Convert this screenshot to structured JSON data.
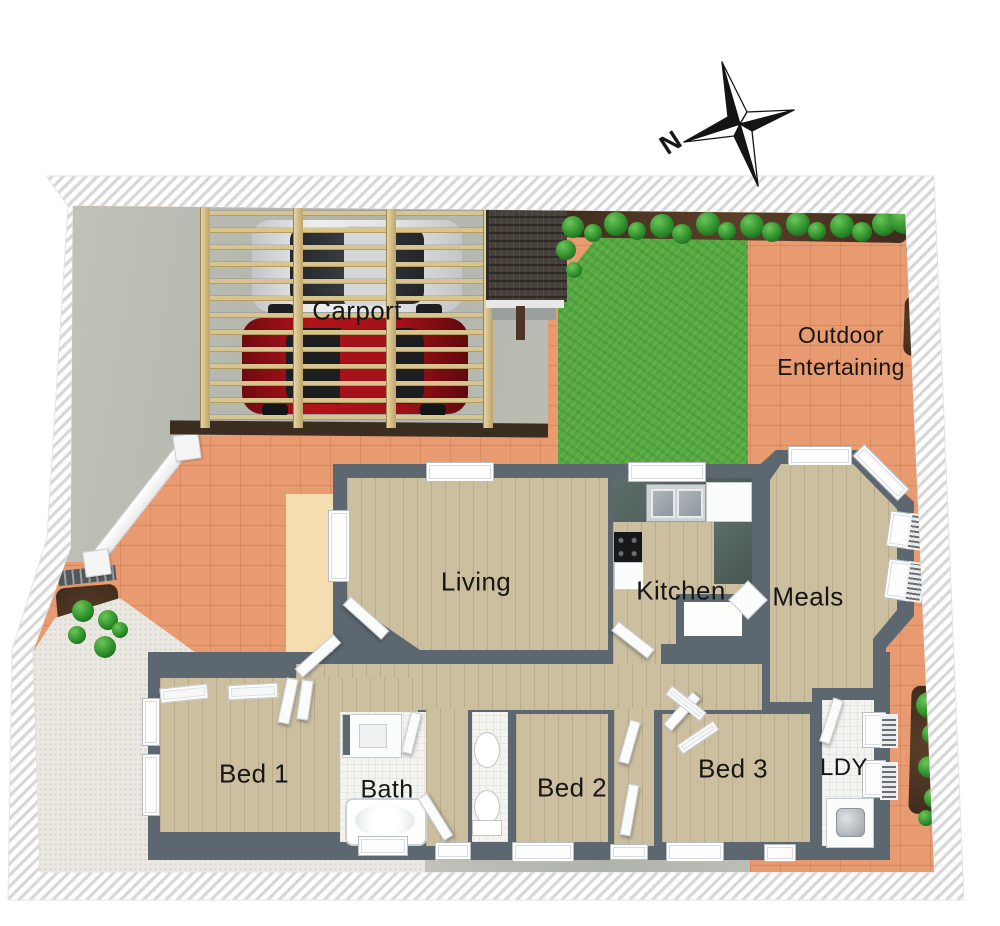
{
  "plan": {
    "labels": {
      "carport": "Carport",
      "outdoor_line1": "Outdoor",
      "outdoor_line2": "Entertaining",
      "living": "Living",
      "kitchen": "Kitchen",
      "meals": "Meals",
      "bed1": "Bed 1",
      "bath": "Bath",
      "bed2": "Bed 2",
      "bed3": "Bed 3",
      "laundry": "LDY"
    },
    "compass": {
      "north": "N"
    },
    "colors": {
      "terracotta": "#E89A71",
      "lawn": "#55A843",
      "concrete": "#B8BAB1",
      "wood": "#CCBFA0",
      "wall": "#5D6770",
      "pergola": "#D8C48E",
      "mulch": "#47321F",
      "shrub": "#3A9A35",
      "gravel": "#EAE8E1",
      "tile": "#F3F3F0",
      "counter": "#4E5F5A",
      "car_red": "#A01118",
      "car_white": "#D9DBDD",
      "roof": "#45413A",
      "deck": "#3B2D20",
      "porch": "#F4DDB0",
      "boundary_hatch": "#D7D7D7"
    }
  }
}
